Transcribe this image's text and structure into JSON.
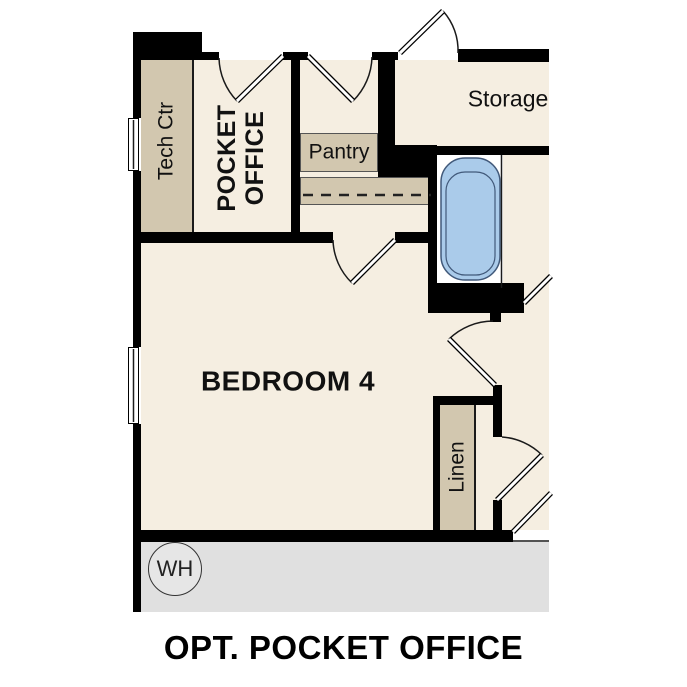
{
  "title": "OPT. POCKET OFFICE",
  "rooms": {
    "tech_ctr": "Tech Ctr",
    "pocket_office": {
      "line1": "POCKET",
      "line2": "OFFICE"
    },
    "pantry": "Pantry",
    "storage": "Storage",
    "bedroom": "BEDROOM 4",
    "linen": "Linen",
    "water_heater": "WH"
  },
  "colors": {
    "floor": "#f5eee1",
    "cabinet": "#d2c7af",
    "wall": "#000000",
    "tub_fill": "#aacbea",
    "tub_stroke": "#41597a",
    "garage_floor": "#e0e0e0",
    "line": "#1a1a1a"
  }
}
